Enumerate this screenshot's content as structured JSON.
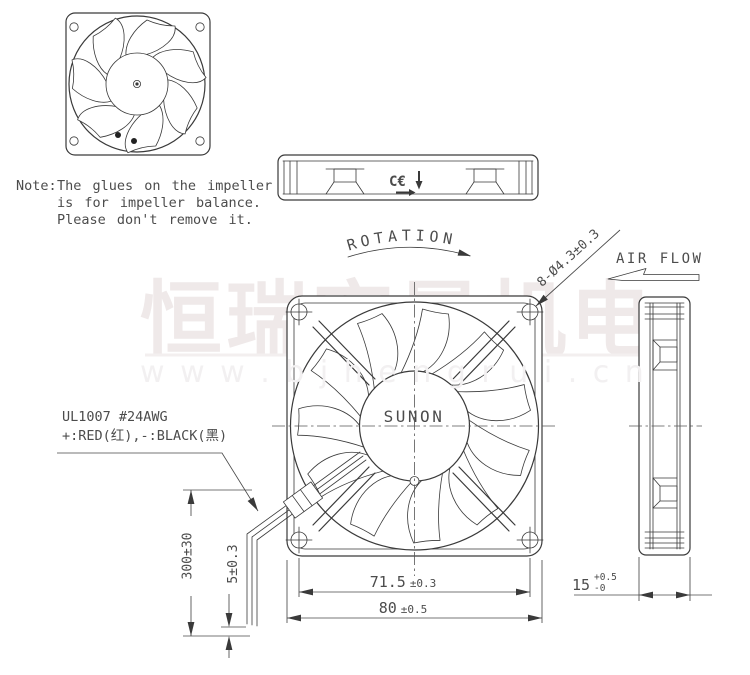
{
  "watermark": {
    "zh": "恒瑞宏晟机电",
    "en": "w w w . b j h e n g r u i . c n"
  },
  "note": {
    "label": "Note:",
    "line1": "The glues on the impeller",
    "line2": "is for impeller balance.",
    "line3": "Please don't remove it."
  },
  "labels": {
    "rotation": "ROTATION",
    "air_flow": "AIR FLOW",
    "mounting_holes": "8-Ø4.3±0.3",
    "brand": "SUNON",
    "ce_mark": "C€"
  },
  "wire_spec": {
    "line1": "UL1007  #24AWG",
    "line2": "+:RED(红),-:BLACK(黑)"
  },
  "dimensions": {
    "lead_length": "300±30",
    "strip_length": "5±0.3",
    "hole_pitch": "71.5",
    "hole_pitch_tol": "±0.3",
    "frame_size": "80",
    "frame_size_tol": "±0.5",
    "thickness": "15",
    "thickness_tol_plus": "+0.5",
    "thickness_tol_minus": "-0"
  },
  "colors": {
    "line": "#3a3a3a",
    "text": "#4c4c4c",
    "watermark_zh": "#efe9e9",
    "watermark_en": "#f2f0f1"
  }
}
